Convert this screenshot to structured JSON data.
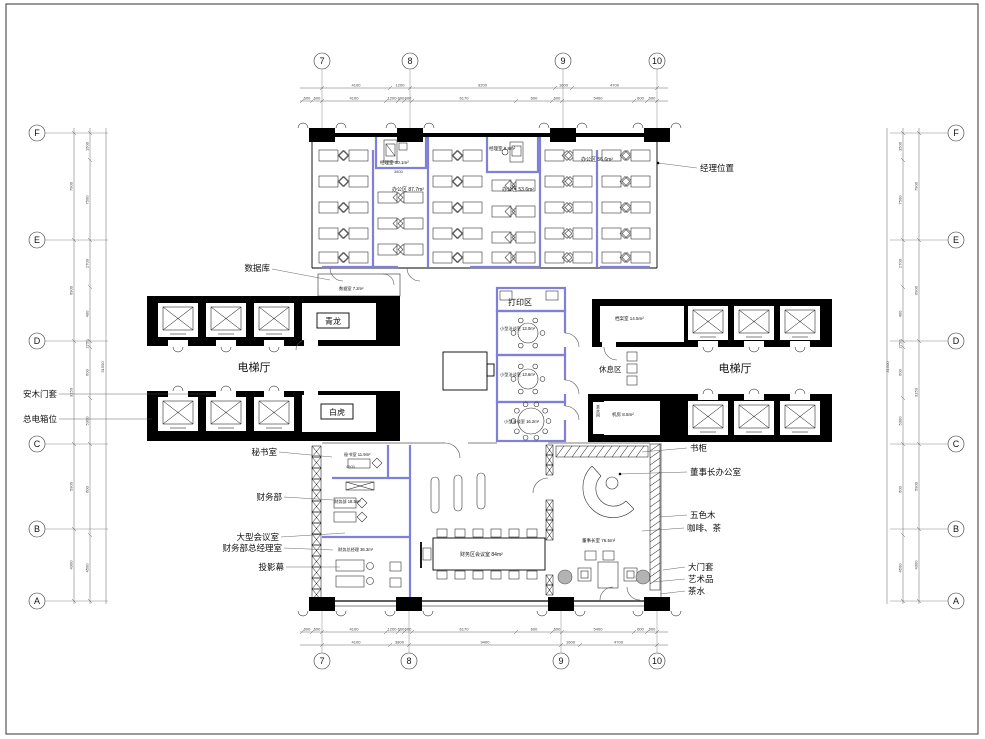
{
  "grid": {
    "cols": [
      "7",
      "8",
      "9",
      "10"
    ],
    "rows": [
      "F",
      "E",
      "D",
      "C",
      "B",
      "A"
    ]
  },
  "halls": {
    "elevator_left": "电梯厅",
    "elevator_right": "电梯厅",
    "qinglong": "青龙",
    "baihu": "白虎",
    "print": "打印区",
    "rest": "休息区",
    "tea": "茶水间"
  },
  "rooms": {
    "mgr1": "经理室 10.1m²",
    "office1": "办公区 87.7m²",
    "mgr2": "经理室 8.8m²",
    "office2": "办公区 53.6m²",
    "office3": "办公区 56.6m²",
    "dataroom": "数据室 7.2m²",
    "archive": "档案室 14.5m²",
    "machine": "机房 8.5m²",
    "meet1": "小型洽谈室 13.0m²",
    "meet2": "小型洽谈室 13.6m²",
    "meet3": "小型洽谈室 16.2m²",
    "secretary": "秘书室 11.9m²",
    "finance": "财务部 18.5m²",
    "finance_gm": "财务总经理 36.3m²",
    "conference": "财务区会议室 84m²",
    "chairman": "董事长室 76.5m²"
  },
  "leaders_left": {
    "database": "数据库",
    "wood_door": "安木门套",
    "power_box": "总电箱位",
    "secretary": "秘书室",
    "finance": "财务部",
    "big_meeting": "大型会议室",
    "finance_gm": "财务部总经理室",
    "projector": "投影幕"
  },
  "leaders_right": {
    "manager_pos": "经理位置",
    "bookcase": "书柜",
    "chairman": "董事长办公室",
    "wood": "五色木",
    "coffee": "咖啡、茶",
    "door_case": "大门套",
    "art": "艺术品",
    "tea": "茶水"
  },
  "dims": {
    "top1": [
      "4100",
      "1200",
      "9200",
      "1600",
      "4700"
    ],
    "top2": [
      "600",
      "600",
      "4100",
      "1200",
      "600",
      "600",
      "6170",
      "600",
      "600",
      "5400",
      "600",
      "600"
    ],
    "bottom1": [
      "600",
      "600",
      "4100",
      "1200",
      "600",
      "600",
      "6170",
      "600",
      "600",
      "5400",
      "600",
      "600"
    ],
    "bottom2": [
      "4100",
      "3800",
      "9400",
      "1600",
      "4700"
    ],
    "left_outer": [
      "7900",
      "6900",
      "3150",
      "5900",
      "4300"
    ],
    "left_inner": [
      "1500",
      "7500",
      "2700",
      "400",
      "2750",
      "600",
      "5300",
      "600",
      "4500"
    ],
    "right_outer": [
      "7900",
      "6900",
      "3150",
      "5900",
      "4300"
    ],
    "right_inner": [
      "1500",
      "7500",
      "2700",
      "400",
      "2750",
      "600",
      "5300",
      "600",
      "4500"
    ],
    "left_total": "31500",
    "right_total": "31500",
    "mgr1_width": "3800",
    "secretary_width": "4500"
  },
  "colors": {
    "partition": "#8080d8",
    "wall": "#000000",
    "dim_text": "#444444",
    "art_fill": "#b3b3b3"
  }
}
